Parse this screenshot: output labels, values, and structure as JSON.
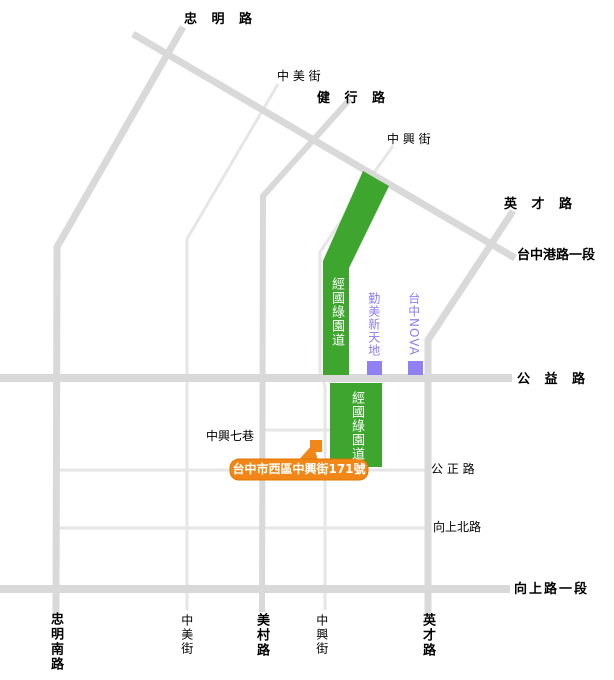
{
  "map_title": "Taichung West District street map",
  "colors": {
    "park_green": "#3ea52f",
    "poi_purple": "#9180f2",
    "marker_orange": "#f28718",
    "road_gray": "#d9d9d9",
    "road_light_gray": "#e6e6e6"
  },
  "roads": {
    "zhongming_rd": "忠 明 路",
    "zhongmei_st_top": "中 美 街",
    "jianxing_rd": "健 行 路",
    "zhongxing_st_top": "中 興 街",
    "yingcai_rd_top": "英 才 路",
    "taichung_port_rd_sec1": "台中港路一段",
    "gongyi_rd": "公 益 路",
    "zhongxing_lane7": "中興七巷",
    "gongzheng_rd": "公 正 路",
    "xiangshang_n_rd": "向上北路",
    "xiangshang_rd_sec1": "向上路一段",
    "zhongming_s_rd": "忠明南路",
    "zhongmei_st_bottom": "中美街",
    "meicun_rd": "美村路",
    "zhongxing_st_bottom": "中興街",
    "yingcai_rd_bottom": "英才路"
  },
  "park": {
    "north_label": "經國綠園道",
    "south_label": "經國綠園道"
  },
  "pois": {
    "qinmei": "勤美新天地",
    "nova": "台中NOVA"
  },
  "marker": {
    "address": "台中市西區中興街171號"
  }
}
